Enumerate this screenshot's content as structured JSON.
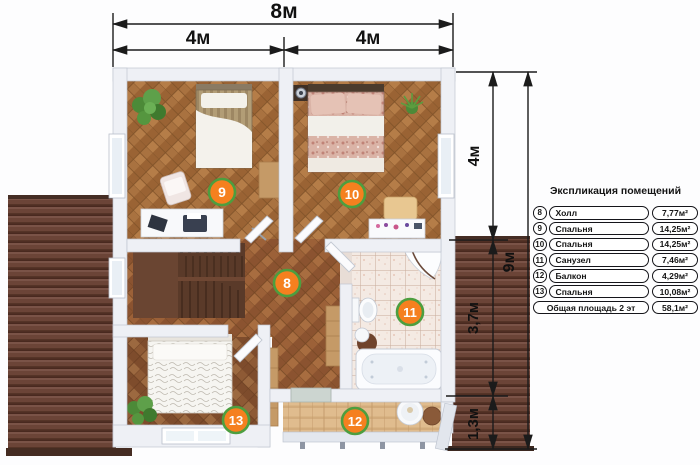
{
  "dimensions": {
    "top_total": "8м",
    "top_left": "4м",
    "top_right": "4м",
    "right_top": "4м",
    "right_total": "9м",
    "right_mid": "3,7м",
    "right_bottom": "1,3м"
  },
  "rooms": {
    "hall": {
      "num": "8"
    },
    "bedroom_left": {
      "num": "9"
    },
    "bedroom_right": {
      "num": "10"
    },
    "bathroom": {
      "num": "11"
    },
    "balcony": {
      "num": "12"
    },
    "bedroom_bottom": {
      "num": "13"
    }
  },
  "legend": {
    "title": "Экспликация помещений",
    "rows": [
      {
        "num": "8",
        "name": "Холл",
        "area": "7,77м²"
      },
      {
        "num": "9",
        "name": "Спальня",
        "area": "14,25м²"
      },
      {
        "num": "10",
        "name": "Спальня",
        "area": "14,25м²"
      },
      {
        "num": "11",
        "name": "Санузел",
        "area": "7,46м²"
      },
      {
        "num": "12",
        "name": "Балкон",
        "area": "4,29м²"
      },
      {
        "num": "13",
        "name": "Спальня",
        "area": "10,08м²"
      }
    ],
    "total": {
      "label": "Общая площадь 2 эт",
      "area": "58,1м²"
    }
  },
  "colors": {
    "badge_fill": "#f5801f",
    "badge_ring": "#4d9e3f",
    "roof": "#6b4437",
    "dimension_line": "#1b1b1b"
  }
}
